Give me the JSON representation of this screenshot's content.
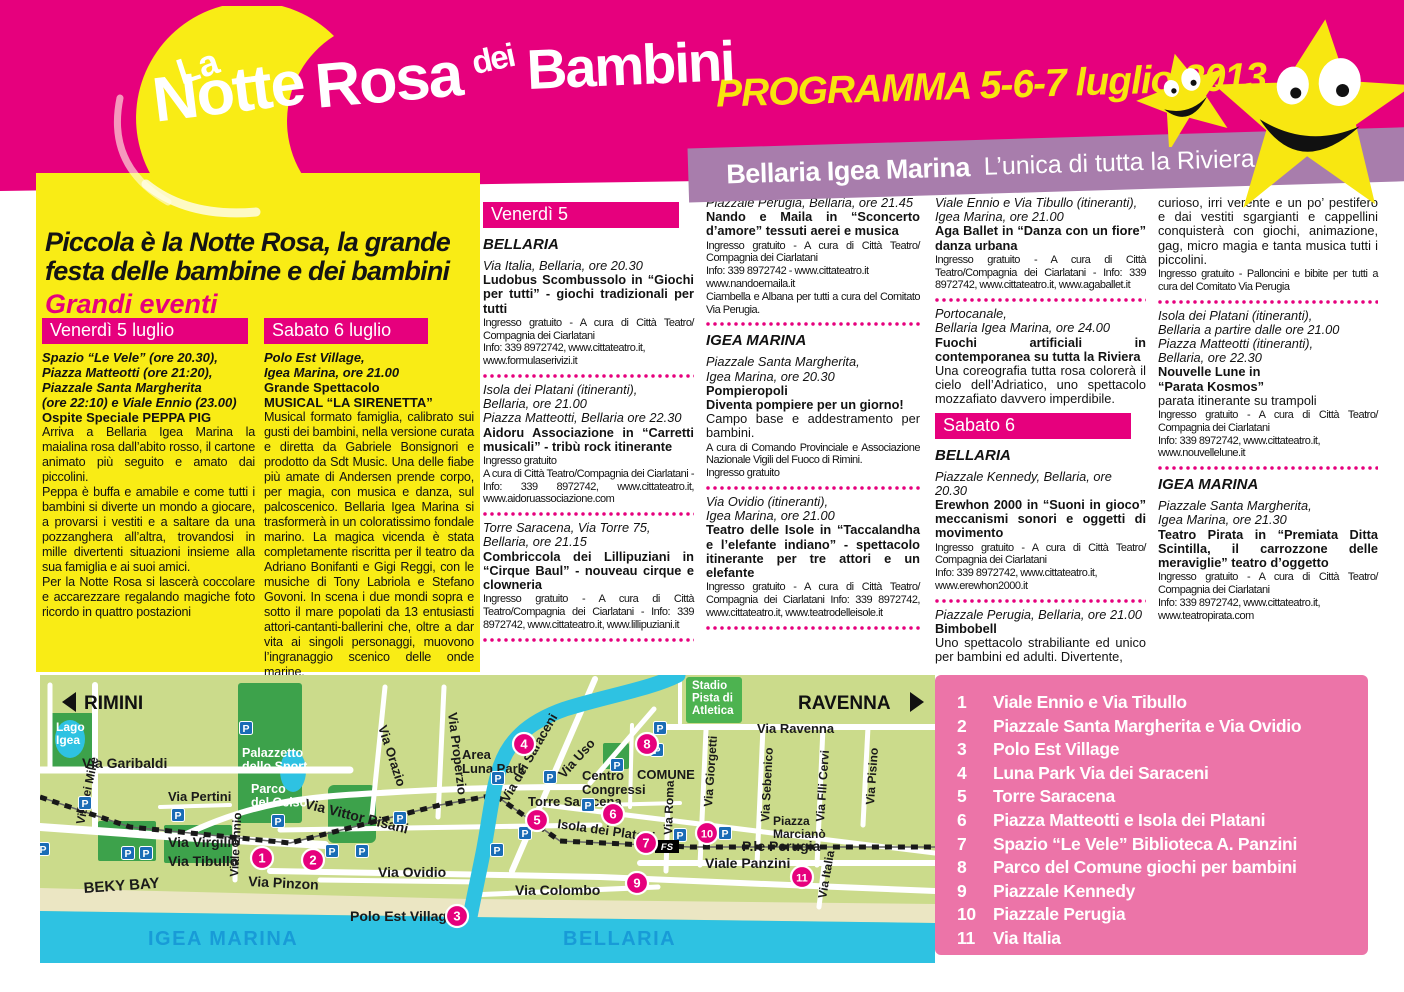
{
  "colors": {
    "magenta": "#e6007d",
    "panel_yellow": "#f9ec15",
    "programma_yellow": "#f7e50e",
    "banner_purple": "#a87dac",
    "legend_pink": "#ec74a8",
    "map": {
      "land": "#cbdb8b",
      "park": "#3da24b",
      "stadium": "#4db350",
      "water": "#2ec2e2",
      "beach": "#ebe6c3",
      "parking_blue": "#1a6cb6",
      "sea_label_blue": "#189bd7",
      "marker": "#e6007d"
    }
  },
  "header": {
    "logo_la": "La",
    "logo_words": [
      "Notte",
      "Rosa",
      "dei",
      "Bambini"
    ],
    "programma": "PROGRAMMA 5-6-7 luglio 2013",
    "banner_bold": "Bellaria Igea Marina",
    "banner_regular": "L’unica di tutta la Riviera"
  },
  "intro": {
    "title1": "Piccola è la Notte Rosa, la grande",
    "title2": "festa delle bambine e dei bambini",
    "subtitle": "Grandi eventi",
    "col1": {
      "header": "Venerdì 5 luglio",
      "venue": [
        "Spazio “Le Vele” (ore 20.30),",
        "Piazza Matteotti (ore 21:20),",
        "Piazzale Santa Margherita",
        "(ore 22:10) e Viale Ennio (23.00)"
      ],
      "highlight": "Ospite Speciale PEPPA PIG",
      "paragraphs": [
        "Arriva a Bellaria Igea Marina la maialina rosa dall’abito rosso, il cartone animato più seguito e amato dai piccolini.",
        "Peppa è buffa e amabile e come tutti i bambini si diverte un mondo a giocare, a provarsi i vestiti e a saltare da una pozzanghera all’altra, trovandosi in mille divertenti situazioni insieme alla sua famiglia e ai suoi amici.",
        "Per la Notte Rosa si lascerà coccolare e accarezzare regalando magiche foto ricordo in quattro postazioni"
      ]
    },
    "col2": {
      "header": "Sabato 6 luglio",
      "venue": [
        "Polo Est Village,",
        "Igea Marina, ore 21.00"
      ],
      "highlight_lines": [
        "Grande Spettacolo",
        "MUSICAL “LA SIRENETTA”"
      ],
      "paragraphs": [
        "Musical formato famiglia, calibrato sui gusti dei bambini, nella versione curata e diretta da Gabriele Bonsignori e prodotto da Sdt Music. Una delle fiabe più amate di Andersen prende corpo, per magia, con musica e danza, sul palcoscenico. Bellaria Igea Marina si trasformerà in un coloratissimo fondale marino. La magica vicenda è stata completamente riscritta per il teatro da Adriano Bonifanti e Gigi Reggi, con le musiche di Tony Labriola e Stefano Govoni. In scena i due mondi sopra e sotto il mare popolati da 13 entusiasti attori-cantanti-ballerini che, oltre a dar vita ai singoli personaggi, muovono l’ingranaggio scenico delle onde marine."
      ],
      "note": "Ingresso gratuito"
    }
  },
  "program": {
    "columns": [
      {
        "items": [
          {
            "type": "bar",
            "text": "Venerdì 5"
          },
          {
            "type": "city",
            "text": "BELLARIA"
          },
          {
            "type": "event",
            "venue": [
              "Via Italia, Bellaria, ore 20.30"
            ],
            "title": "Ludobus Scombussolo in “Giochi per tutti” - giochi tradizionali per tutti",
            "info": "Ingresso gratuito - A cura di Città Teatro/ Compagnia dei Ciarlatani\nInfo: 339 8972742, www.cittateatro.it,\nwww.formulaserivizi.it"
          },
          {
            "type": "sep"
          },
          {
            "type": "event",
            "venue": [
              "Isola dei Platani (itineranti),",
              "Bellaria, ore 21.00",
              "Piazza Matteotti, Bellaria ore 22.30"
            ],
            "title": "Aidoru Associazione in “Carretti musicali” - tribù rock itinerante",
            "info": "Ingresso gratuito\nA cura di Città Teatro/Compagnia dei Ciarlatani - Info: 339 8972742, www.cittateatro.it, www.aidoruassociazione.com"
          },
          {
            "type": "sep"
          },
          {
            "type": "event",
            "venue": [
              "Torre Saracena, Via Torre 75,",
              "Bellaria, ore 21.15"
            ],
            "title": "Combriccola dei Lillipuziani in “Cirque Baul” - nouveau cirque e clowneria",
            "info": "Ingresso gratuito - A cura di Città Teatro/Compagnia dei Ciarlatani - Info: 339 8972742, www.cittateatro.it, www.lillipuziani.it"
          },
          {
            "type": "sep"
          }
        ]
      },
      {
        "items": [
          {
            "type": "event",
            "venue": [
              "Piazzale Perugia, Bellaria, ore 21.45"
            ],
            "title": "Nando e Maila in “Sconcerto d’amore” tessuti aerei e musica",
            "info": "Ingresso gratuito - A cura di Città Teatro/ Compagnia dei Ciarlatani\nInfo: 339 8972742 - www.cittateatro.it\nwww.nandoemaila.it\nCiambella e Albana per tutti a cura del Comitato Via Perugia."
          },
          {
            "type": "sep"
          },
          {
            "type": "city",
            "text": "IGEA MARINA"
          },
          {
            "type": "event",
            "venue": [
              "Piazzale Santa Margherita,",
              "Igea Marina, ore 20.30"
            ],
            "title": "Pompieropoli\nDiventa pompiere per un giorno!",
            "body": "Campo base e addestramento per bambini.",
            "info": "A cura di Comando Provinciale e Associazione Nazionale Vigili del Fuoco di Rimini.\nIngresso gratuito"
          },
          {
            "type": "sep"
          },
          {
            "type": "event",
            "venue": [
              "Via Ovidio (itineranti),",
              "Igea Marina, ore 21.00"
            ],
            "title": "Teatro delle Isole in “Taccalandha e l’elefante indiano” - spettacolo itinerante per tre attori e un elefante",
            "info": "Ingresso gratuito - A cura di Città Teatro/ Compagnia dei Ciarlatani Info: 339 8972742, www.cittateatro.it, www.teatrodelleisole.it"
          },
          {
            "type": "sep"
          }
        ]
      },
      {
        "items": [
          {
            "type": "event",
            "venue": [
              "Viale Ennio e Via Tibullo (itineranti),",
              "Igea Marina, ore 21.00"
            ],
            "title": "Aga Ballet in “Danza con un fiore” danza urbana",
            "info": "Ingresso gratuito - A cura di Città Teatro/Compagnia dei Ciarlatani - Info: 339 8972742, www.cittateatro.it, www.agaballet.it"
          },
          {
            "type": "sep"
          },
          {
            "type": "event",
            "venue": [
              "Portocanale,",
              "Bellaria Igea Marina, ore 24.00"
            ],
            "title": "Fuochi artificiali in contemporanea su tutta la Riviera",
            "body": "Una coreografia tutta rosa colorerà il cielo dell’Adriatico, uno spettacolo mozzafiato davvero imperdibile."
          },
          {
            "type": "bar",
            "text": "Sabato 6"
          },
          {
            "type": "city",
            "text": "BELLARIA"
          },
          {
            "type": "event",
            "venue": [
              "Piazzale Kennedy, Bellaria, ore 20.30"
            ],
            "title": "Erewhon 2000 in “Suoni in gioco” meccanismi sonori e oggetti di movimento",
            "info": "Ingresso gratuito - A cura di Città Teatro/ Compagnia dei Ciarlatani\nInfo: 339 8972742, www.cittateatro.it,\nwww.erewhon2000.it"
          },
          {
            "type": "sep"
          },
          {
            "type": "event",
            "venue": [
              "Piazzale Perugia, Bellaria, ore 21.00"
            ],
            "title": "Bimbobell",
            "body": "Uno spettacolo strabiliante ed unico per bambini ed adulti. Divertente,"
          }
        ]
      },
      {
        "items": [
          {
            "type": "event",
            "body": "curioso, irri verente e un po’ pestifero e dai vestiti sgargianti e cappellini conquisterà con giochi, animazione, gag, micro magia e tanta musica tutti i piccolini.",
            "info": "Ingresso gratuito - Palloncini e bibite per tutti a cura del Comitato Via Perugia"
          },
          {
            "type": "sep"
          },
          {
            "type": "event",
            "venue": [
              "Isola dei Platani (itineranti),",
              "Bellaria a partire dalle ore 21.00",
              "Piazza Matteotti (itineranti),",
              "Bellaria, ore 22.30"
            ],
            "title": "Nouvelle Lune in\n“Parata Kosmos”",
            "body": "parata itinerante su trampoli",
            "info": "Ingresso gratuito - A cura di Città Teatro/ Compagnia dei Ciarlatani\nInfo: 339 8972742, www.cittateatro.it,\nwww.nouvellelune.it"
          },
          {
            "type": "sep"
          },
          {
            "type": "city",
            "text": "IGEA MARINA"
          },
          {
            "type": "event",
            "venue": [
              "Piazzale Santa Margherita,",
              "Igea Marina, ore 21.30"
            ],
            "title": "Teatro Pirata in “Premiata Ditta Scintilla, il carrozzone delle meraviglie” teatro d’oggetto",
            "info": "Ingresso gratuito - A cura di Città Teatro/ Compagnia dei Ciarlatani\nInfo: 339 8972742, www.cittateatro.it,\nwww.teatropirata.com"
          }
        ]
      }
    ]
  },
  "legend": {
    "items": [
      {
        "n": "1",
        "label": "Viale Ennio e Via Tibullo"
      },
      {
        "n": "2",
        "label": "Piazzale Santa Margherita e Via Ovidio"
      },
      {
        "n": "3",
        "label": "Polo Est Village"
      },
      {
        "n": "4",
        "label": "Luna Park Via dei Saraceni"
      },
      {
        "n": "5",
        "label": "Torre Saracena"
      },
      {
        "n": "6",
        "label": "Piazza Matteotti e Isola dei Platani"
      },
      {
        "n": "7",
        "label": "Spazio “Le Vele” Biblioteca A. Panzini"
      },
      {
        "n": "8",
        "label": "Parco del Comune giochi per bambini"
      },
      {
        "n": "9",
        "label": "Piazzale Kennedy"
      },
      {
        "n": "10",
        "label": "Piazzale Perugia"
      },
      {
        "n": "11",
        "label": "Via Italia"
      }
    ]
  },
  "map": {
    "labels": [
      {
        "t": "Lago\nIgea",
        "x": 16,
        "y": 56,
        "s": 12,
        "c": "w"
      },
      {
        "t": "Via Garibaldi",
        "x": 42,
        "y": 93,
        "s": 14
      },
      {
        "t": "Via dei Mille",
        "x": 44,
        "y": 150,
        "s": 12,
        "r": -78
      },
      {
        "t": "Via Pertini",
        "x": 128,
        "y": 126,
        "s": 13
      },
      {
        "t": "Palazzetto\ndello Sport",
        "x": 202,
        "y": 82,
        "s": 12.5,
        "c": "w"
      },
      {
        "t": "Parco\ndel Gelso",
        "x": 211,
        "y": 118,
        "s": 12.5,
        "c": "w"
      },
      {
        "t": "Via Virgilio",
        "x": 128,
        "y": 172,
        "s": 14
      },
      {
        "t": "Via Tibullo",
        "x": 128,
        "y": 191,
        "s": 14
      },
      {
        "t": "Viale Ennio",
        "x": 198,
        "y": 202,
        "s": 12,
        "r": -87
      },
      {
        "t": "Via Pinzon",
        "x": 208,
        "y": 211,
        "s": 14,
        "r": 3
      },
      {
        "t": "Via Vittor Pisani",
        "x": 264,
        "y": 133,
        "s": 14,
        "r": 14
      },
      {
        "t": "BEKY BAY",
        "x": 44,
        "y": 218,
        "s": 15,
        "r": -4
      },
      {
        "t": "Via Ovidio",
        "x": 338,
        "y": 202,
        "s": 14
      },
      {
        "t": "Polo Est Village",
        "x": 310,
        "y": 246,
        "s": 14
      },
      {
        "t": "Via Orazio",
        "x": 338,
        "y": 52,
        "s": 13,
        "r": 72
      },
      {
        "t": "Via Properzio",
        "x": 408,
        "y": 38,
        "s": 13,
        "r": 83
      },
      {
        "t": "Area\nLuna Park",
        "x": 422,
        "y": 84,
        "s": 13
      },
      {
        "t": "Via dei Saraceni",
        "x": 468,
        "y": 128,
        "s": 13,
        "r": -60
      },
      {
        "t": "Via Uso",
        "x": 524,
        "y": 104,
        "s": 13,
        "r": -48
      },
      {
        "t": "Torre Saracena",
        "x": 488,
        "y": 131,
        "s": 13
      },
      {
        "t": "Isola dei Platani",
        "x": 517,
        "y": 153,
        "s": 13,
        "r": 8
      },
      {
        "t": "Via Colombo",
        "x": 475,
        "y": 220,
        "s": 14
      },
      {
        "t": "Centro\nCongressi",
        "x": 542,
        "y": 105,
        "s": 13
      },
      {
        "t": "COMUNE",
        "x": 597,
        "y": 104,
        "s": 13
      },
      {
        "t": "Via Roma",
        "x": 632,
        "y": 160,
        "s": 12,
        "r": -88
      },
      {
        "t": "Via Giorgetti",
        "x": 672,
        "y": 132,
        "s": 12,
        "r": -86
      },
      {
        "t": "Via Ravenna",
        "x": 717,
        "y": 58,
        "s": 13
      },
      {
        "t": "Via Sebenico",
        "x": 729,
        "y": 147,
        "s": 12,
        "r": -87
      },
      {
        "t": "Piazza\nMarcianò",
        "x": 733,
        "y": 150,
        "s": 12
      },
      {
        "t": "Via Flli Cervi",
        "x": 784,
        "y": 147,
        "s": 12,
        "r": -86
      },
      {
        "t": "Via Pisino",
        "x": 834,
        "y": 130,
        "s": 12,
        "r": -86
      },
      {
        "t": "P.le Perugia",
        "x": 702,
        "y": 176,
        "s": 14
      },
      {
        "t": "Viale Panzini",
        "x": 665,
        "y": 193,
        "s": 14
      },
      {
        "t": "Via Italia",
        "x": 786,
        "y": 224,
        "s": 12,
        "r": -80
      },
      {
        "t": "Stadio\nPista di\nAtletica",
        "x": 652,
        "y": 14,
        "s": 11.5,
        "c": "w"
      },
      {
        "t": "IGEA MARINA",
        "x": 108,
        "y": 270,
        "s": 20,
        "c": "b"
      },
      {
        "t": "BELLARIA",
        "x": 523,
        "y": 270,
        "s": 20,
        "c": "b"
      }
    ],
    "markers": [
      {
        "n": "1",
        "x": 222,
        "y": 183
      },
      {
        "n": "2",
        "x": 273,
        "y": 185
      },
      {
        "n": "3",
        "x": 417,
        "y": 241
      },
      {
        "n": "4",
        "x": 484,
        "y": 69
      },
      {
        "n": "5",
        "x": 497,
        "y": 145
      },
      {
        "n": "6",
        "x": 573,
        "y": 139
      },
      {
        "n": "7",
        "x": 606,
        "y": 168
      },
      {
        "n": "8",
        "x": 607,
        "y": 69
      },
      {
        "n": "9",
        "x": 597,
        "y": 208
      },
      {
        "n": "10",
        "x": 667,
        "y": 158
      },
      {
        "n": "11",
        "x": 762,
        "y": 202
      }
    ],
    "parkings": [
      {
        "x": 45,
        "y": 128
      },
      {
        "x": 3,
        "y": 174
      },
      {
        "x": 88,
        "y": 178
      },
      {
        "x": 106,
        "y": 178
      },
      {
        "x": 138,
        "y": 140
      },
      {
        "x": 206,
        "y": 53
      },
      {
        "x": 238,
        "y": 146
      },
      {
        "x": 292,
        "y": 176
      },
      {
        "x": 322,
        "y": 176
      },
      {
        "x": 360,
        "y": 143
      },
      {
        "x": 458,
        "y": 103
      },
      {
        "x": 510,
        "y": 102
      },
      {
        "x": 485,
        "y": 158
      },
      {
        "x": 457,
        "y": 175
      },
      {
        "x": 548,
        "y": 130
      },
      {
        "x": 577,
        "y": 90
      },
      {
        "x": 620,
        "y": 53
      },
      {
        "x": 617,
        "y": 75
      },
      {
        "x": 640,
        "y": 160
      },
      {
        "x": 685,
        "y": 158
      }
    ],
    "parking_letter": "P",
    "fs_label": "FS",
    "directions": [
      {
        "t": "RIMINI",
        "x": 44,
        "y": 34,
        "tri": "22,27 36,17 36,37"
      },
      {
        "t": "RAVENNA",
        "x": 758,
        "y": 34,
        "tri": "870,17 870,37 884,27"
      }
    ]
  }
}
